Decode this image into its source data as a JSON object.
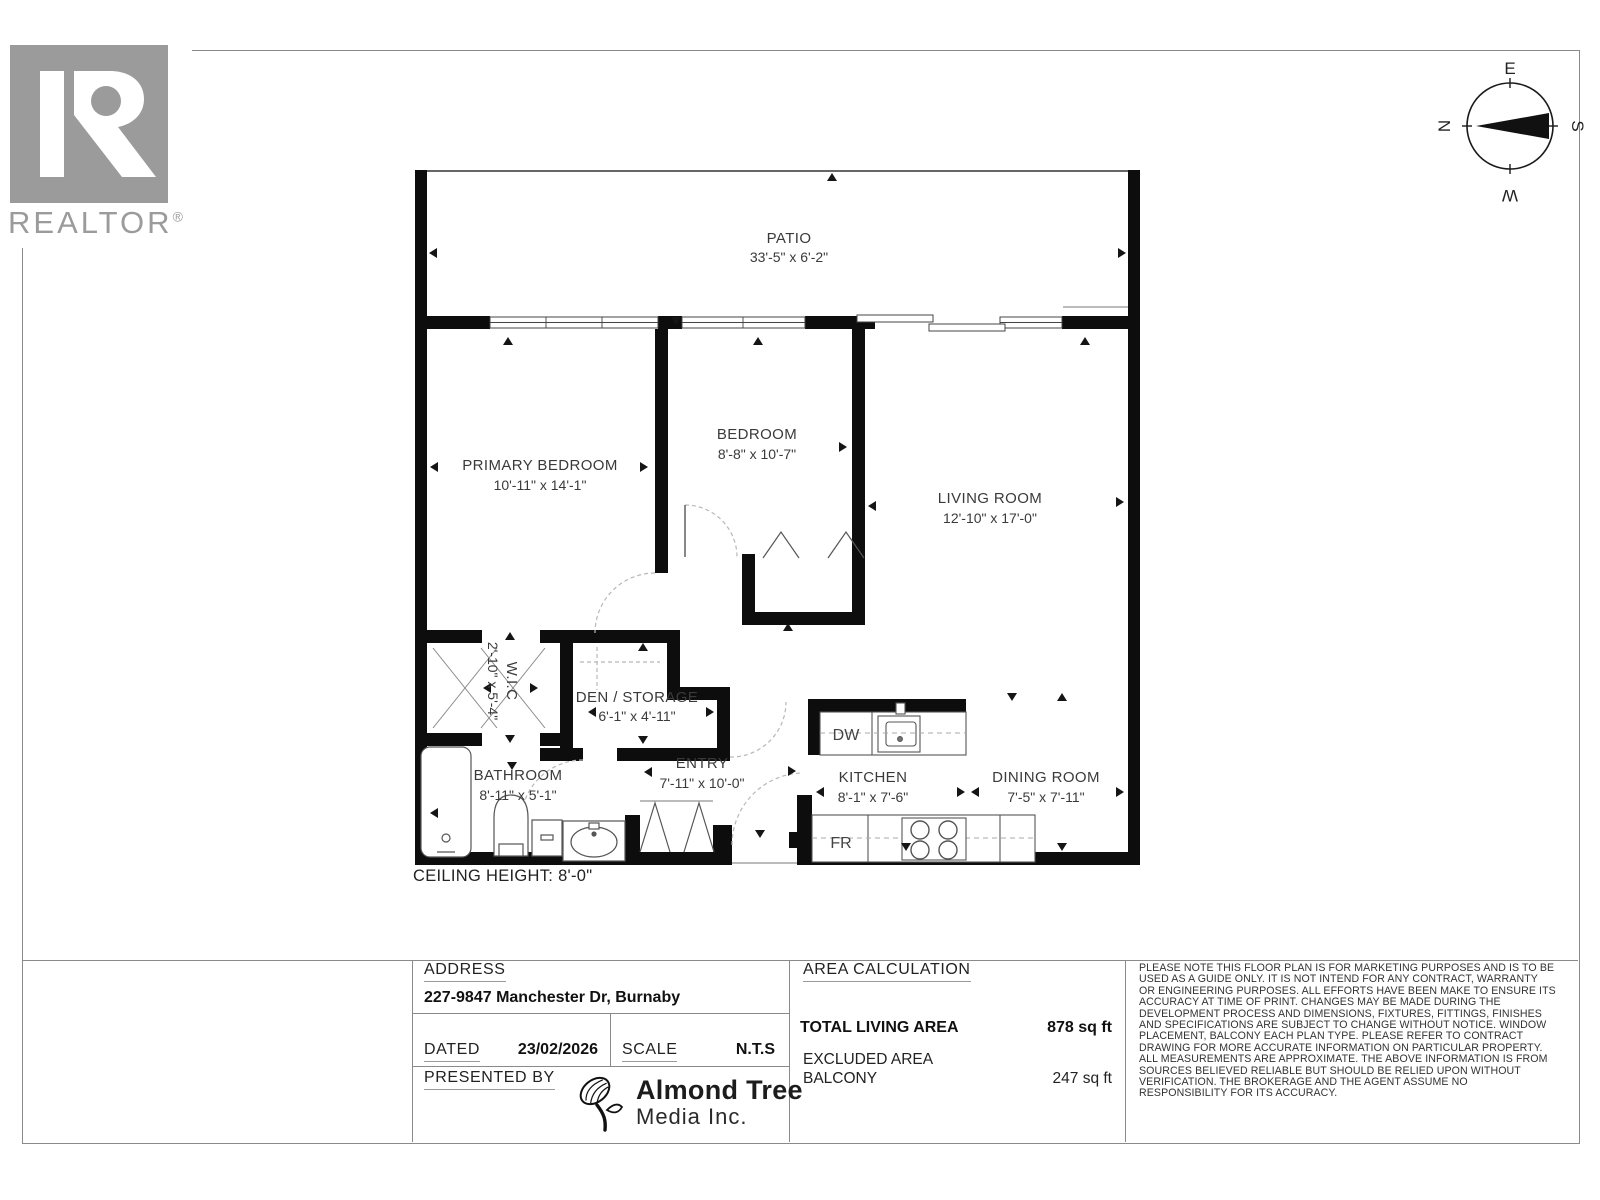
{
  "branding": {
    "realtor_wordmark": "REALTOR",
    "registered_mark": "®",
    "almond_line1": "Almond Tree",
    "almond_line2": "Media Inc."
  },
  "compass": {
    "north": "N",
    "east": "E",
    "south": "S",
    "west": "W"
  },
  "plan": {
    "ceiling_note": "CEILING HEIGHT: 8'-0\"",
    "rooms": {
      "patio": {
        "name": "PATIO",
        "dims": "33'-5\" x 6'-2\""
      },
      "primary_bedroom": {
        "name": "PRIMARY BEDROOM",
        "dims": "10'-11\" x 14'-1\""
      },
      "bedroom": {
        "name": "BEDROOM",
        "dims": "8'-8\" x 10'-7\""
      },
      "living_room": {
        "name": "LIVING ROOM",
        "dims": "12'-10\" x 17'-0\""
      },
      "wic": {
        "name": "W.I.C",
        "dims": "2'-10\" x 5'-4\""
      },
      "den": {
        "name": "DEN / STORAGE",
        "dims": "6'-1\" x 4'-11\""
      },
      "bathroom": {
        "name": "BATHROOM",
        "dims": "8'-11\" x 5'-1\""
      },
      "entry": {
        "name": "ENTRY",
        "dims": "7'-11\" x 10'-0\""
      },
      "kitchen": {
        "name": "KITCHEN",
        "dims": "8'-1\" x 7'-6\""
      },
      "dining": {
        "name": "DINING ROOM",
        "dims": "7'-5\" x 7'-11\""
      }
    },
    "appliances": {
      "dishwasher": "DW",
      "fridge": "FR"
    }
  },
  "titleblock": {
    "address_label": "ADDRESS",
    "address_value": "227-9847 Manchester Dr, Burnaby",
    "dated_label": "DATED",
    "dated_value": "23/02/2026",
    "scale_label": "SCALE",
    "scale_value": "N.T.S",
    "presented_by_label": "PRESENTED BY",
    "area_calc_label": "AREA CALCULATION",
    "total_living_label": "TOTAL LIVING AREA",
    "total_living_value": "878 sq ft",
    "excluded_label": "EXCLUDED AREA",
    "balcony_label": "BALCONY",
    "balcony_value": "247 sq ft",
    "disclaimer": "PLEASE NOTE THIS FLOOR PLAN IS FOR MARKETING PURPOSES AND IS TO BE\nUSED AS A GUIDE ONLY. IT IS NOT INTEND FOR ANY CONTRACT, WARRANTY\nOR ENGINEERING PURPOSES. ALL EFFORTS HAVE BEEN MAKE TO ENSURE ITS\nACCURACY AT TIME OF PRINT. CHANGES MAY BE MADE DURING THE\nDEVELOPMENT PROCESS AND DIMENSIONS, FIXTURES, FITTINGS, FINISHES\nAND SPECIFICATIONS ARE SUBJECT TO CHANGE WITHOUT NOTICE. WINDOW\nPLACEMENT, BALCONY EACH PLAN TYPE. PLEASE REFER TO CONTRACT\nDRAWING FOR MORE ACCURATE INFORMATION ON PARTICULAR PROPERTY.\nALL MEASUREMENTS ARE APPROXIMATE. THE ABOVE INFORMATION IS FROM\nSOURCES BELIEVED RELIABLE BUT SHOULD BE RELIED UPON WITHOUT\nVERIFICATION. THE BROKERAGE AND THE AGENT ASSUME NO\nRESPONSIBILITY FOR ITS ACCURACY."
  }
}
